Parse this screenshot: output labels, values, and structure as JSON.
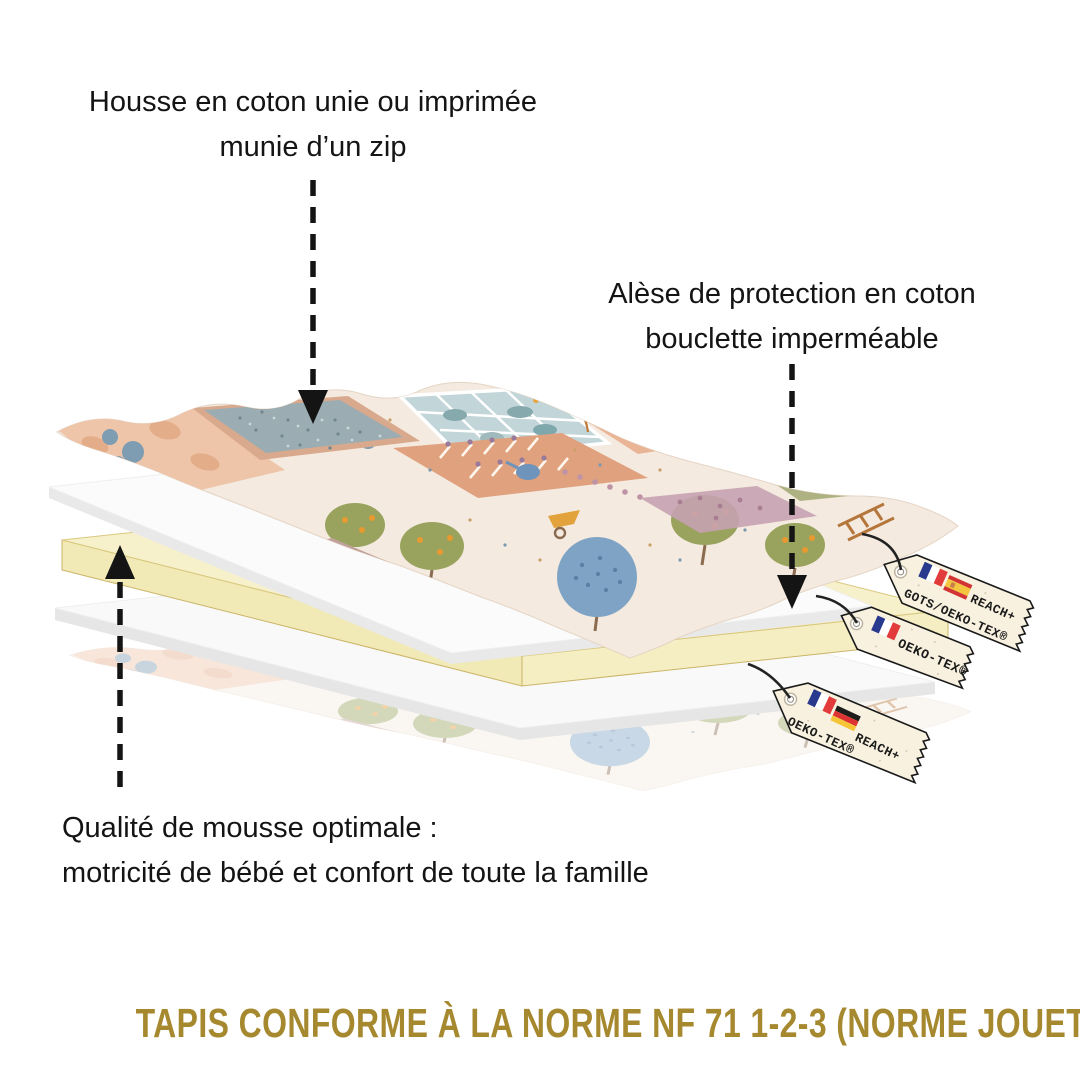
{
  "captions": {
    "cover": {
      "line1": "Housse en coton unie ou imprimée",
      "line2": "munie d’un zip"
    },
    "protector": {
      "line1": "Alèse de protection en coton",
      "line2": "bouclette imperméable"
    },
    "foam": {
      "line1": "Qualité de mousse optimale :",
      "line2": "motricité de bébé et confort de toute la famille"
    }
  },
  "footer": {
    "label": "TAPIS CONFORME À LA NORME NF 71 1-2-3 (NORME JOUET)",
    "color": "#A6892F"
  },
  "tags": [
    {
      "name": "cover-certification",
      "flags": [
        "France",
        "Spain"
      ],
      "line1": "REACH+",
      "line2": "GOTS/OEKO-TEX®"
    },
    {
      "name": "protector-certification",
      "flags": [
        "France"
      ],
      "line1": "OEKO-TEX®",
      "line2": ""
    },
    {
      "name": "foam-certification",
      "flags": [
        "France",
        "Germany"
      ],
      "line1": "REACH+",
      "line2": "OEKO-TEX®"
    }
  ],
  "colors": {
    "accent_gold": "#A6892F",
    "foam_yellow": "#F7F1CB",
    "tag_cream": "#F8F1DF",
    "fabric_base": "#F4EADF",
    "text": "#141414",
    "flag_blue": "#28398E",
    "flag_red": "#E23B3B"
  }
}
